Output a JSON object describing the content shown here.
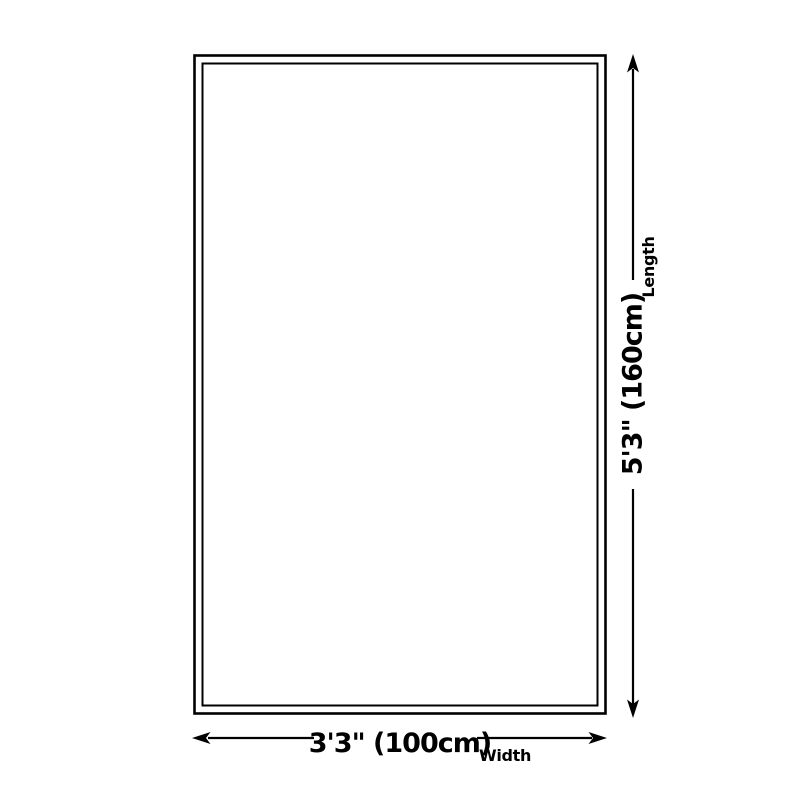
{
  "page": {
    "background_color": "#ffffff",
    "line_color": "#000000"
  },
  "diagram": {
    "shape": "rectangle-with-double-border",
    "length": {
      "value": "5'3\" (160cm)",
      "label": "Length"
    },
    "width": {
      "value": "3'3\" (100cm)",
      "label": "Width"
    }
  }
}
